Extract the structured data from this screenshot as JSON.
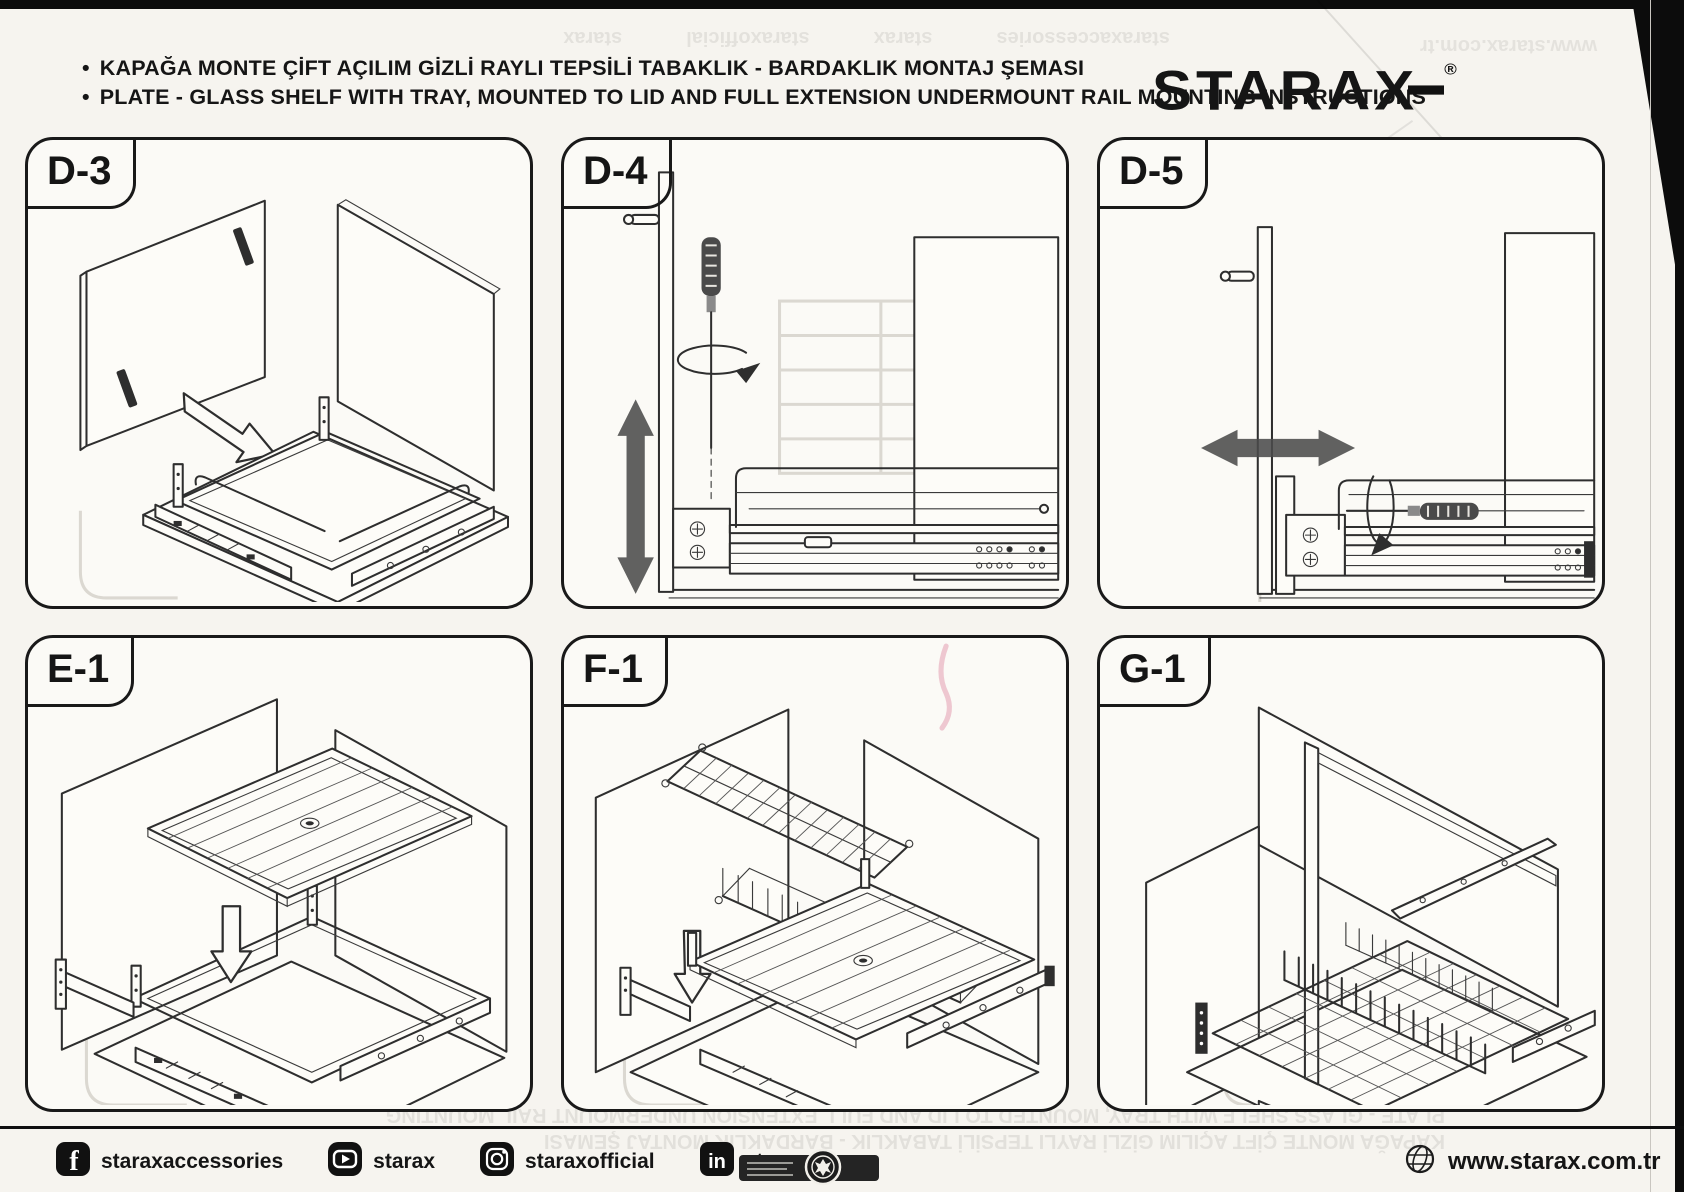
{
  "header": {
    "bullet": "•",
    "title_tr": "KAPAĞA MONTE ÇİFT AÇILIM GİZLİ RAYLI TEPSİLİ TABAKLIK - BARDAKLIK MONTAJ ŞEMASI",
    "title_en": "PLATE - GLASS SHELF WITH TRAY, MOUNTED TO LID AND FULL EXTENSION UNDERMOUNT RAIL MOUNTING INSTRUCTIONS",
    "brand": "STARAX",
    "registered_mark": "®"
  },
  "panels": [
    {
      "label": "D-3"
    },
    {
      "label": "D-4"
    },
    {
      "label": "D-5"
    },
    {
      "label": "E-1"
    },
    {
      "label": "F-1"
    },
    {
      "label": "G-1"
    }
  ],
  "footer": {
    "social": [
      {
        "icon": "facebook-icon",
        "label": "staraxaccessories"
      },
      {
        "icon": "youtube-icon",
        "label": "starax"
      },
      {
        "icon": "instagram-icon",
        "label": "staraxofficial"
      },
      {
        "icon": "linkedin-icon",
        "label": "starax"
      }
    ],
    "website": "www.starax.com.tr"
  },
  "colors": {
    "paper": "#f6f4ef",
    "ink": "#151515",
    "line_art": "#2e2e2e",
    "solid_arrow": "#4b4b4b",
    "showthrough": "#6d6b66"
  }
}
